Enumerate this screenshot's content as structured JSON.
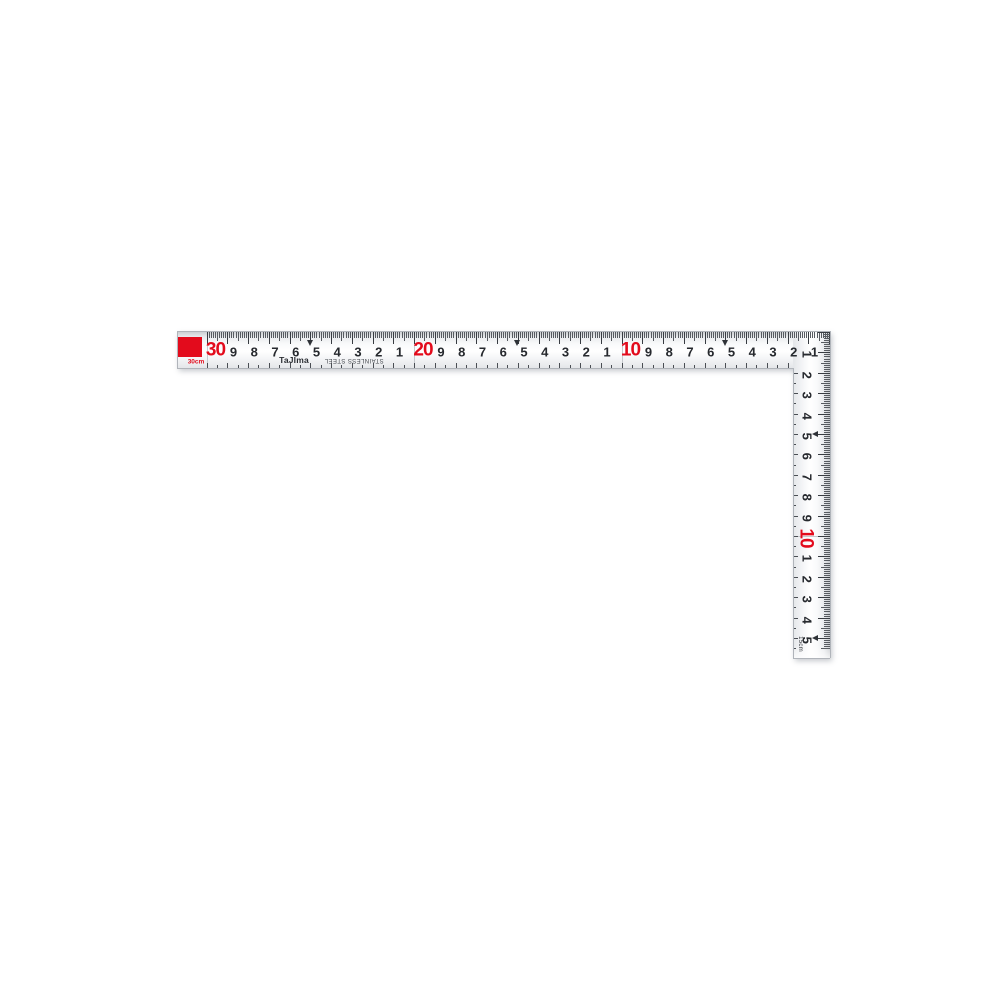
{
  "product": {
    "name": "carpenter-square",
    "brand": "TaJIma",
    "material": "STAINLESS STEEL"
  },
  "colors": {
    "red": "#e30b1c",
    "ink": "#26292e",
    "blade_edge": "#b0b4ba"
  },
  "horizontal_scale": {
    "length_caption": "30cm",
    "unit": "cm",
    "arrow_marks_cm": [
      5,
      15,
      25
    ],
    "numbers": [
      {
        "cm": 1,
        "label": "1",
        "red": false
      },
      {
        "cm": 2,
        "label": "2",
        "red": false
      },
      {
        "cm": 3,
        "label": "3",
        "red": false
      },
      {
        "cm": 4,
        "label": "4",
        "red": false
      },
      {
        "cm": 5,
        "label": "5",
        "red": false
      },
      {
        "cm": 6,
        "label": "6",
        "red": false
      },
      {
        "cm": 7,
        "label": "7",
        "red": false
      },
      {
        "cm": 8,
        "label": "8",
        "red": false
      },
      {
        "cm": 9,
        "label": "9",
        "red": false
      },
      {
        "cm": 10,
        "label": "10",
        "red": true
      },
      {
        "cm": 11,
        "label": "1",
        "red": false
      },
      {
        "cm": 12,
        "label": "2",
        "red": false
      },
      {
        "cm": 13,
        "label": "3",
        "red": false
      },
      {
        "cm": 14,
        "label": "4",
        "red": false
      },
      {
        "cm": 15,
        "label": "5",
        "red": false
      },
      {
        "cm": 16,
        "label": "6",
        "red": false
      },
      {
        "cm": 17,
        "label": "7",
        "red": false
      },
      {
        "cm": 18,
        "label": "8",
        "red": false
      },
      {
        "cm": 19,
        "label": "9",
        "red": false
      },
      {
        "cm": 20,
        "label": "20",
        "red": true
      },
      {
        "cm": 21,
        "label": "1",
        "red": false
      },
      {
        "cm": 22,
        "label": "2",
        "red": false
      },
      {
        "cm": 23,
        "label": "3",
        "red": false
      },
      {
        "cm": 24,
        "label": "4",
        "red": false
      },
      {
        "cm": 25,
        "label": "5",
        "red": false
      },
      {
        "cm": 26,
        "label": "6",
        "red": false
      },
      {
        "cm": 27,
        "label": "7",
        "red": false
      },
      {
        "cm": 28,
        "label": "8",
        "red": false
      },
      {
        "cm": 29,
        "label": "9",
        "red": false
      },
      {
        "cm": 30,
        "label": "30",
        "red": true
      }
    ]
  },
  "vertical_scale": {
    "length_caption": "15cm",
    "unit": "cm",
    "arrow_marks_cm": [
      5,
      15
    ],
    "numbers": [
      {
        "cm": 1,
        "label": "1",
        "red": false
      },
      {
        "cm": 2,
        "label": "2",
        "red": false
      },
      {
        "cm": 3,
        "label": "3",
        "red": false
      },
      {
        "cm": 4,
        "label": "4",
        "red": false
      },
      {
        "cm": 5,
        "label": "5",
        "red": false
      },
      {
        "cm": 6,
        "label": "6",
        "red": false
      },
      {
        "cm": 7,
        "label": "7",
        "red": false
      },
      {
        "cm": 8,
        "label": "8",
        "red": false
      },
      {
        "cm": 9,
        "label": "9",
        "red": false
      },
      {
        "cm": 10,
        "label": "10",
        "red": true
      },
      {
        "cm": 11,
        "label": "1",
        "red": false
      },
      {
        "cm": 12,
        "label": "2",
        "red": false
      },
      {
        "cm": 13,
        "label": "3",
        "red": false
      },
      {
        "cm": 14,
        "label": "4",
        "red": false
      },
      {
        "cm": 15,
        "label": "5",
        "red": false
      }
    ]
  }
}
